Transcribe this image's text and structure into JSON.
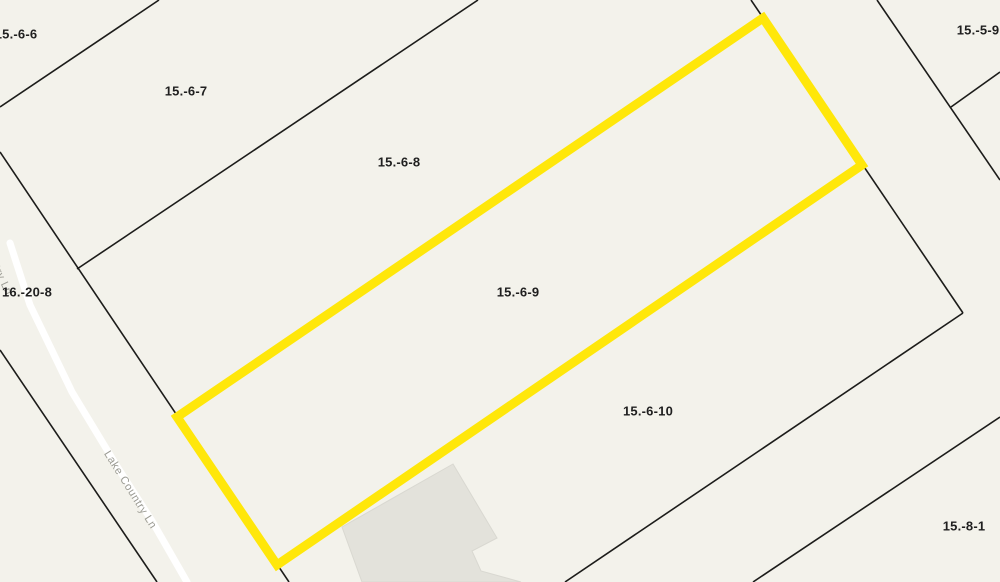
{
  "map": {
    "canvas": {
      "width": 1000,
      "height": 582
    },
    "colors": {
      "background": "#f3f2eb",
      "boundary_line": "#1c1c1a",
      "highlight": "#ffe70a",
      "building_fill": "#e3e2db",
      "building_edge": "#d9d8d1",
      "road_fill": "#ffffff",
      "parcel_label": "#1f1f1f",
      "road_label": "#9b9b93"
    },
    "highlighted_parcel": {
      "id": "15.-6-9",
      "polygon": [
        [
          177,
          417
        ],
        [
          763,
          18
        ],
        [
          862,
          165
        ],
        [
          277,
          565
        ]
      ],
      "stroke_width": 9
    },
    "boundary_lines": [
      {
        "name": "boundary-15-6-6--15-6-7",
        "points": [
          [
            0,
            107
          ],
          [
            159,
            0
          ]
        ]
      },
      {
        "name": "boundary-15-6-7--15-6-8",
        "points": [
          [
            77,
            269
          ],
          [
            478,
            0
          ]
        ]
      },
      {
        "name": "front-line-along-road",
        "points": [
          [
            0,
            152
          ],
          [
            289,
            582
          ]
        ]
      },
      {
        "name": "back-line-of-strips",
        "points": [
          [
            751,
            0
          ],
          [
            963,
            313
          ]
        ]
      },
      {
        "name": "boundary-15-6-10-south",
        "points": [
          [
            963,
            313
          ],
          [
            565,
            582
          ]
        ]
      },
      {
        "name": "boundary-15-5-9-west",
        "points": [
          [
            877,
            0
          ],
          [
            1000,
            180
          ]
        ]
      },
      {
        "name": "boundary-15-5-9-south",
        "points": [
          [
            951,
            107
          ],
          [
            1000,
            72
          ]
        ]
      },
      {
        "name": "road-west-boundary",
        "points": [
          [
            0,
            350
          ],
          [
            157,
            582
          ]
        ]
      },
      {
        "name": "boundary-15-8-1-north",
        "points": [
          [
            753,
            582
          ],
          [
            1000,
            417
          ]
        ]
      }
    ],
    "building": {
      "polygon": [
        [
          453,
          464
        ],
        [
          497,
          538
        ],
        [
          472,
          551
        ],
        [
          481,
          571
        ],
        [
          521,
          582
        ],
        [
          362,
          582
        ],
        [
          342,
          527
        ]
      ]
    },
    "road": {
      "name": "Lake Country Ln",
      "centerline": [
        [
          10,
          243
        ],
        [
          30,
          305
        ],
        [
          72,
          392
        ],
        [
          118,
          468
        ],
        [
          152,
          521
        ],
        [
          187,
          582
        ]
      ],
      "width": 7,
      "labels": [
        {
          "text": "Lake Country Ln",
          "x": 130,
          "y": 490,
          "rotation": 58
        },
        {
          "text": "Lake Country Ln",
          "x": -10,
          "y": 254,
          "rotation": 65
        }
      ]
    },
    "parcel_labels": [
      {
        "text": "15.-6-6",
        "x": 16,
        "y": 35
      },
      {
        "text": "15.-6-7",
        "x": 186,
        "y": 92
      },
      {
        "text": "15.-6-8",
        "x": 399,
        "y": 163
      },
      {
        "text": "15.-6-9",
        "x": 518,
        "y": 293
      },
      {
        "text": "15.-6-10",
        "x": 648,
        "y": 412
      },
      {
        "text": "15.-5-9",
        "x": 978,
        "y": 31
      },
      {
        "text": "16.-20-8",
        "x": 27,
        "y": 293
      },
      {
        "text": "15.-8-1",
        "x": 964,
        "y": 527
      }
    ]
  }
}
